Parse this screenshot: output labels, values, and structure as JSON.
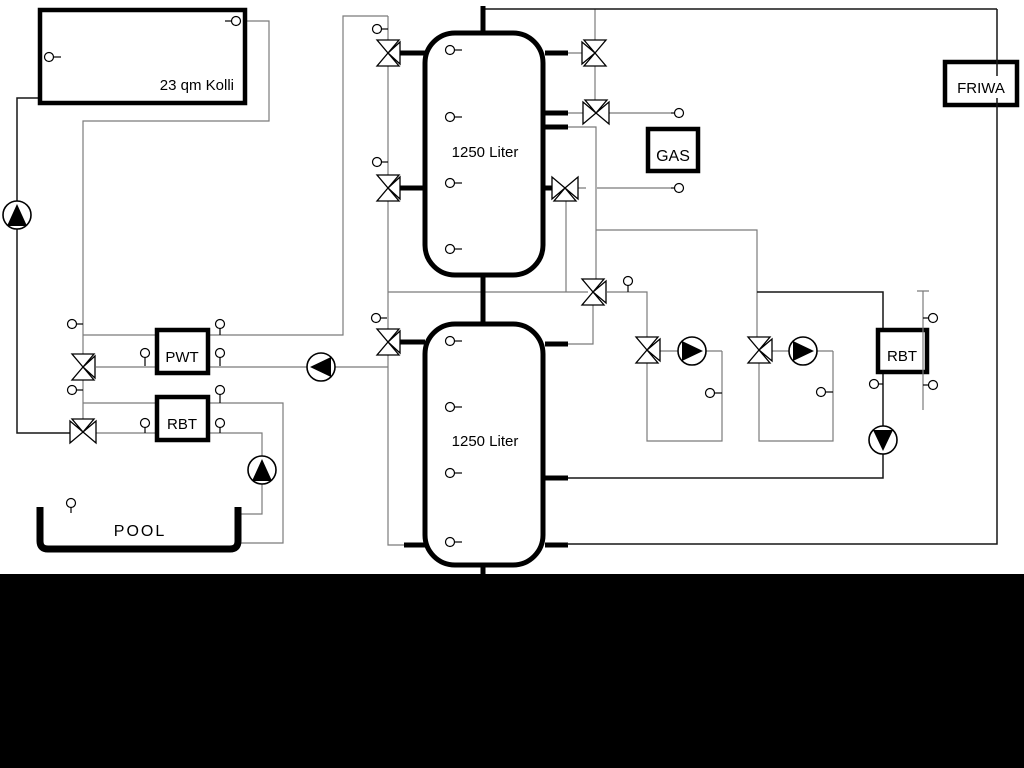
{
  "labels": {
    "collector": "23 qm Kolli",
    "upper_tank": "1250 Liter",
    "lower_tank": "1250 Liter",
    "pwt": "PWT",
    "rbt_left": "RBT",
    "rbt_right": "RBT",
    "gas": "GAS",
    "friwa": "FRIWA",
    "pool": "POOL"
  },
  "colors": {
    "background": "#ffffff",
    "pipe_gray": "#7b7b7b",
    "pipe_black": "#161616",
    "component_outline": "#000000",
    "bottom_band": "#000000"
  }
}
